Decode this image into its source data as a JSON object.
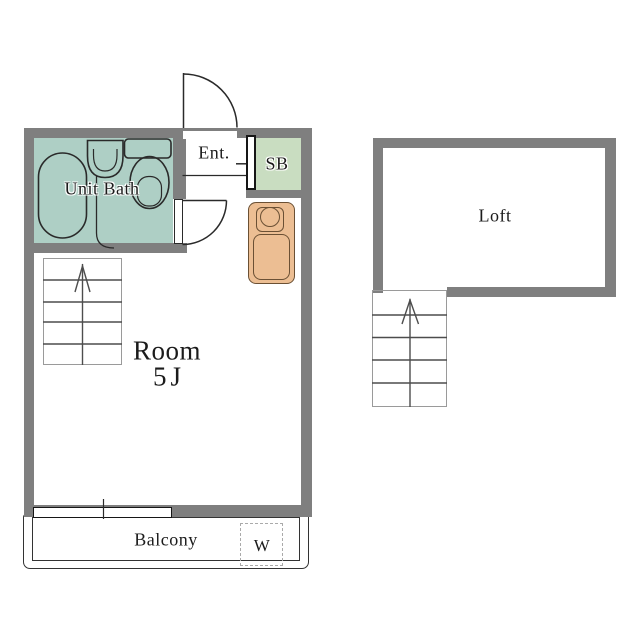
{
  "title": "Apartment floor plan with loft",
  "rooms": {
    "unit_bath": {
      "label": "Unit Bath"
    },
    "entrance": {
      "label": "Ent."
    },
    "shoe_box": {
      "label": "SB"
    },
    "main_room": {
      "label": "Room",
      "size": "5J"
    },
    "balcony": {
      "label": "Balcony"
    },
    "washer": {
      "label": "W"
    },
    "loft": {
      "label": "Loft"
    }
  },
  "stairs": {
    "main_steps": 5,
    "loft_steps": 5,
    "direction": "up"
  },
  "fixtures": [
    "bathtub",
    "washbasin",
    "toilet",
    "kitchenette-sink",
    "washing-machine-space",
    "entrance-door",
    "bath-door",
    "window"
  ],
  "colors": {
    "wall": "#7f7f7f",
    "bath": "#aecfc5",
    "sb": "#c9ddc1",
    "kitchen": "#ecbe93",
    "kline": "#6b5034",
    "stair": "#4d4d4d",
    "boxline": "#9a9a9a",
    "dash": "#aaaaaa"
  }
}
